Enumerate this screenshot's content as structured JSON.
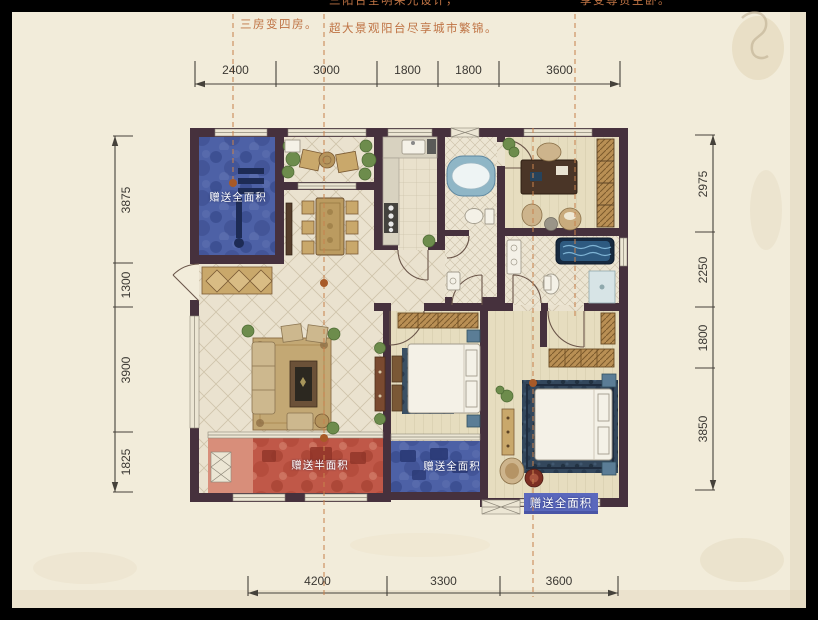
{
  "annotations": {
    "col1": "三房变四房。",
    "col2_line1": "三阳台全明采光设计，",
    "col2_line2": "超大景观阳台尽享城市繁锦。",
    "col3": "享受尊贵主卧。"
  },
  "dimensions": {
    "top": [
      "2400",
      "3000",
      "1800",
      "1800",
      "3600"
    ],
    "bottom": [
      "4200",
      "3300",
      "3600"
    ],
    "left": [
      "3875",
      "1300",
      "3900",
      "1825"
    ],
    "right": [
      "2975",
      "2250",
      "1800",
      "3850"
    ]
  },
  "gift_labels": {
    "top_left": "赠送全面积",
    "bottom_left": "赠送半面积",
    "bottom_middle": "赠送全面积",
    "bottom_right": "赠送全面积"
  },
  "colors": {
    "background": "#000000",
    "paper": "#f2ecda",
    "wall": "#46313d",
    "gift_blue": "#4d61a6",
    "gift_red": "#c05848",
    "gift_red_light": "#d88e7a",
    "banner_blue": "#5a68bd",
    "guide_dashed": "#c8834e",
    "annotation_text": "#bf7344",
    "dimension_text": "#3b3833",
    "gift_label_text": "#ffffff"
  }
}
